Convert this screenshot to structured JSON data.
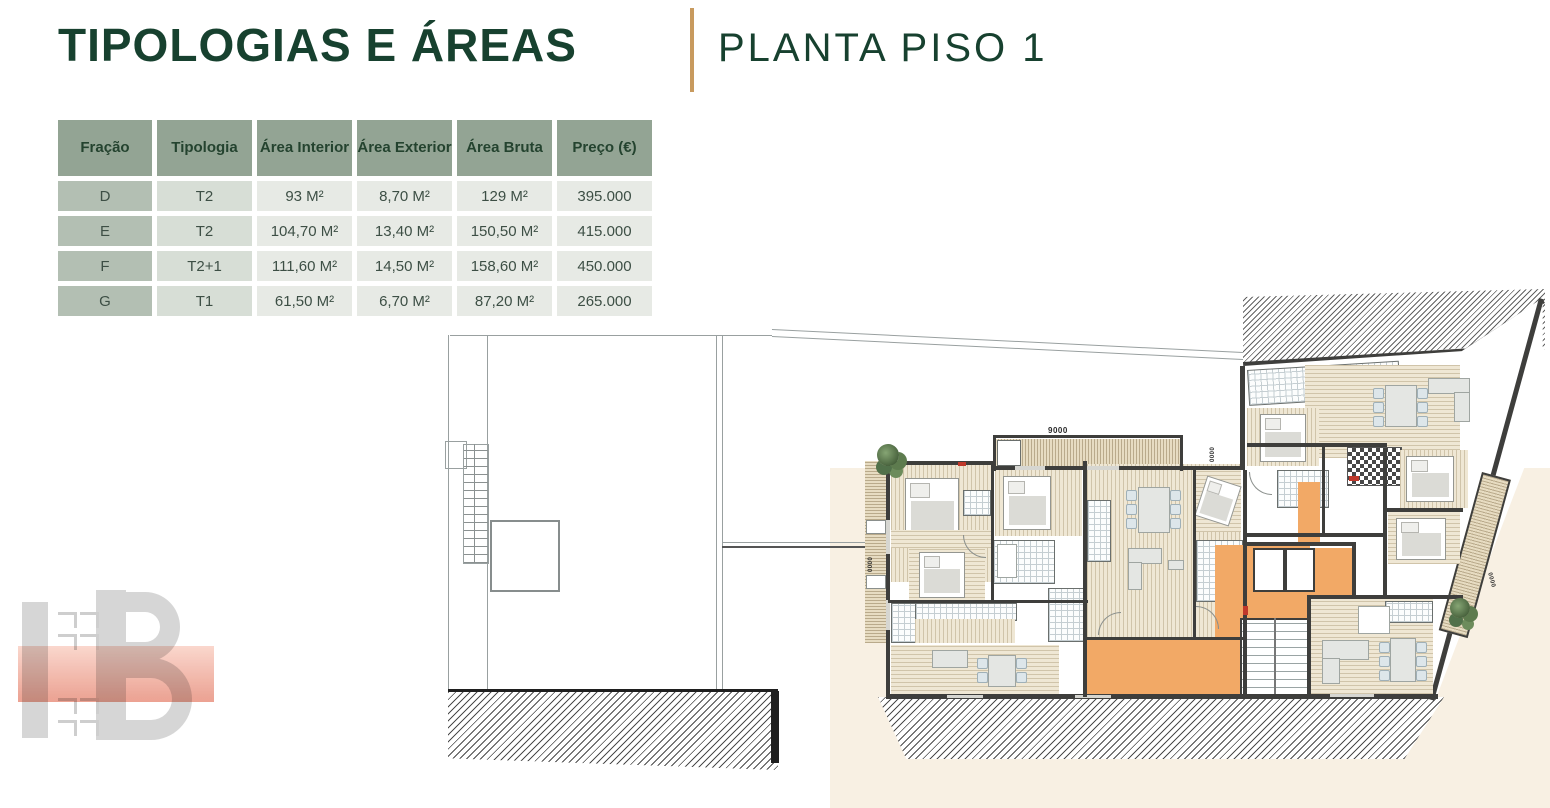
{
  "header": {
    "title": "TIPOLOGIAS E ÁREAS",
    "subtitle": "PLANTA PISO 1"
  },
  "table": {
    "columns": [
      "Fração",
      "Tipologia",
      "Área Interior",
      "Área Exterior",
      "Área Bruta",
      "Preço (€)"
    ],
    "rows": [
      [
        "D",
        "T2",
        "93 M²",
        "8,70 M²",
        "129 M²",
        "395.000"
      ],
      [
        "E",
        "T2",
        "104,70 M²",
        "13,40 M²",
        "150,50 M²",
        "415.000"
      ],
      [
        "F",
        "T2+1",
        "111,60 M²",
        "14,50 M²",
        "158,60 M²",
        "450.000"
      ],
      [
        "G",
        "T1",
        "61,50 M²",
        "6,70 M²",
        "87,20 M²",
        "265.000"
      ]
    ]
  },
  "plan": {
    "dim_top": "9000",
    "dim_west": "0000",
    "dim_terrace": "0000",
    "dim_east": "0000"
  },
  "logo": {
    "monogram": "HB"
  },
  "colors": {
    "title_green": "#17412f",
    "accent_gold": "#c89a5e",
    "table_header": "#93a494",
    "corridor_orange": "#f2a966",
    "plan_cream": "#f8f0e3"
  }
}
